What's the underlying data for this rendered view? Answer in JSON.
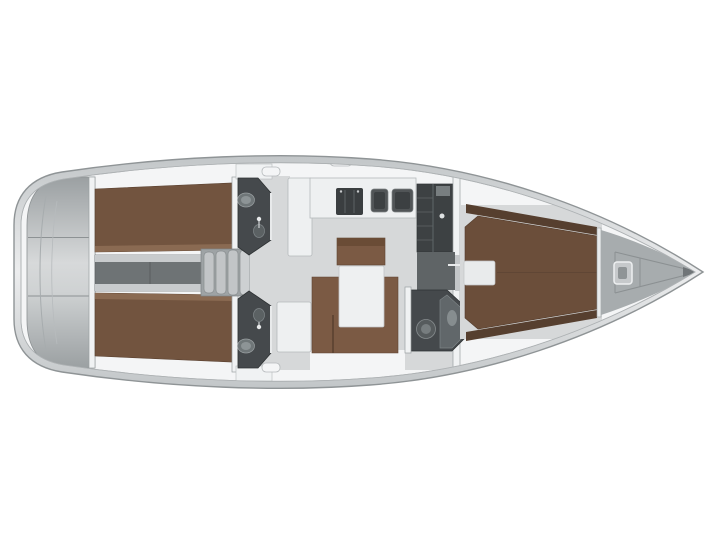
{
  "diagram": {
    "type": "yacht-interior-floor-plan",
    "orientation": "bow-right",
    "description": "Top-down layout plan of a sailing yacht interior"
  },
  "colors": {
    "background": "#ffffff",
    "hullRim": "#c5c9cb",
    "hullRimLight": "#ebedee",
    "hullStroke": "#8f9496",
    "innerWhite": "#f4f5f6",
    "floor": "#d6d8d9",
    "floorDim": "#c3c6c8",
    "berth": "#72543f",
    "berthFwd": "#6b4e3a",
    "berthLight": "#8a6a52",
    "berthDark": "#563f2f",
    "seating": "#7b5a44",
    "seatingEdge": "#5e4433",
    "headFloor": "#45494c",
    "headEdge": "#2e3234",
    "fixture": "#7e8587",
    "fixtureLight": "#9aa0a2",
    "whiteFurniture": "#eef0f1",
    "furnitureStroke": "#b5b9bb",
    "steps": "#c2c5c7",
    "stepsBase": "#9ea3a5",
    "corridorDark": "#6e7375",
    "rail": "#c8cbcd",
    "appliance": "#3a3e40",
    "wardrobe": "#3d4143",
    "shelfLine": "#5f6567",
    "wallStroke": "#9aa0a2",
    "sternDark": "#9ba0a2",
    "sternLight": "#d7d9da",
    "bowDeck": "#a7acae",
    "bowLine": "#8b9092",
    "trim": "#e8eaeb"
  },
  "rooms": [
    {
      "id": "transom-locker",
      "label": "Stern / transom locker"
    },
    {
      "id": "aft-cabin-port",
      "label": "Aft double cabin (port)"
    },
    {
      "id": "aft-cabin-starboard",
      "label": "Aft double cabin (starboard)"
    },
    {
      "id": "engine-compartment",
      "label": "Engine compartment"
    },
    {
      "id": "companionway-steps",
      "label": "Companionway steps"
    },
    {
      "id": "head-port",
      "label": "Head / WC (port)"
    },
    {
      "id": "head-starboard",
      "label": "Head / WC (starboard)"
    },
    {
      "id": "galley",
      "label": "Galley with stove and sinks"
    },
    {
      "id": "wardrobe",
      "label": "Wardrobe / locker"
    },
    {
      "id": "salon",
      "label": "Salon"
    },
    {
      "id": "dinette",
      "label": "Dinette with table"
    },
    {
      "id": "forward-shower",
      "label": "Forward shower room"
    },
    {
      "id": "forward-cabin",
      "label": "Forward owner cabin with island berth"
    },
    {
      "id": "anchor-locker",
      "label": "Anchor locker with windlass"
    }
  ]
}
